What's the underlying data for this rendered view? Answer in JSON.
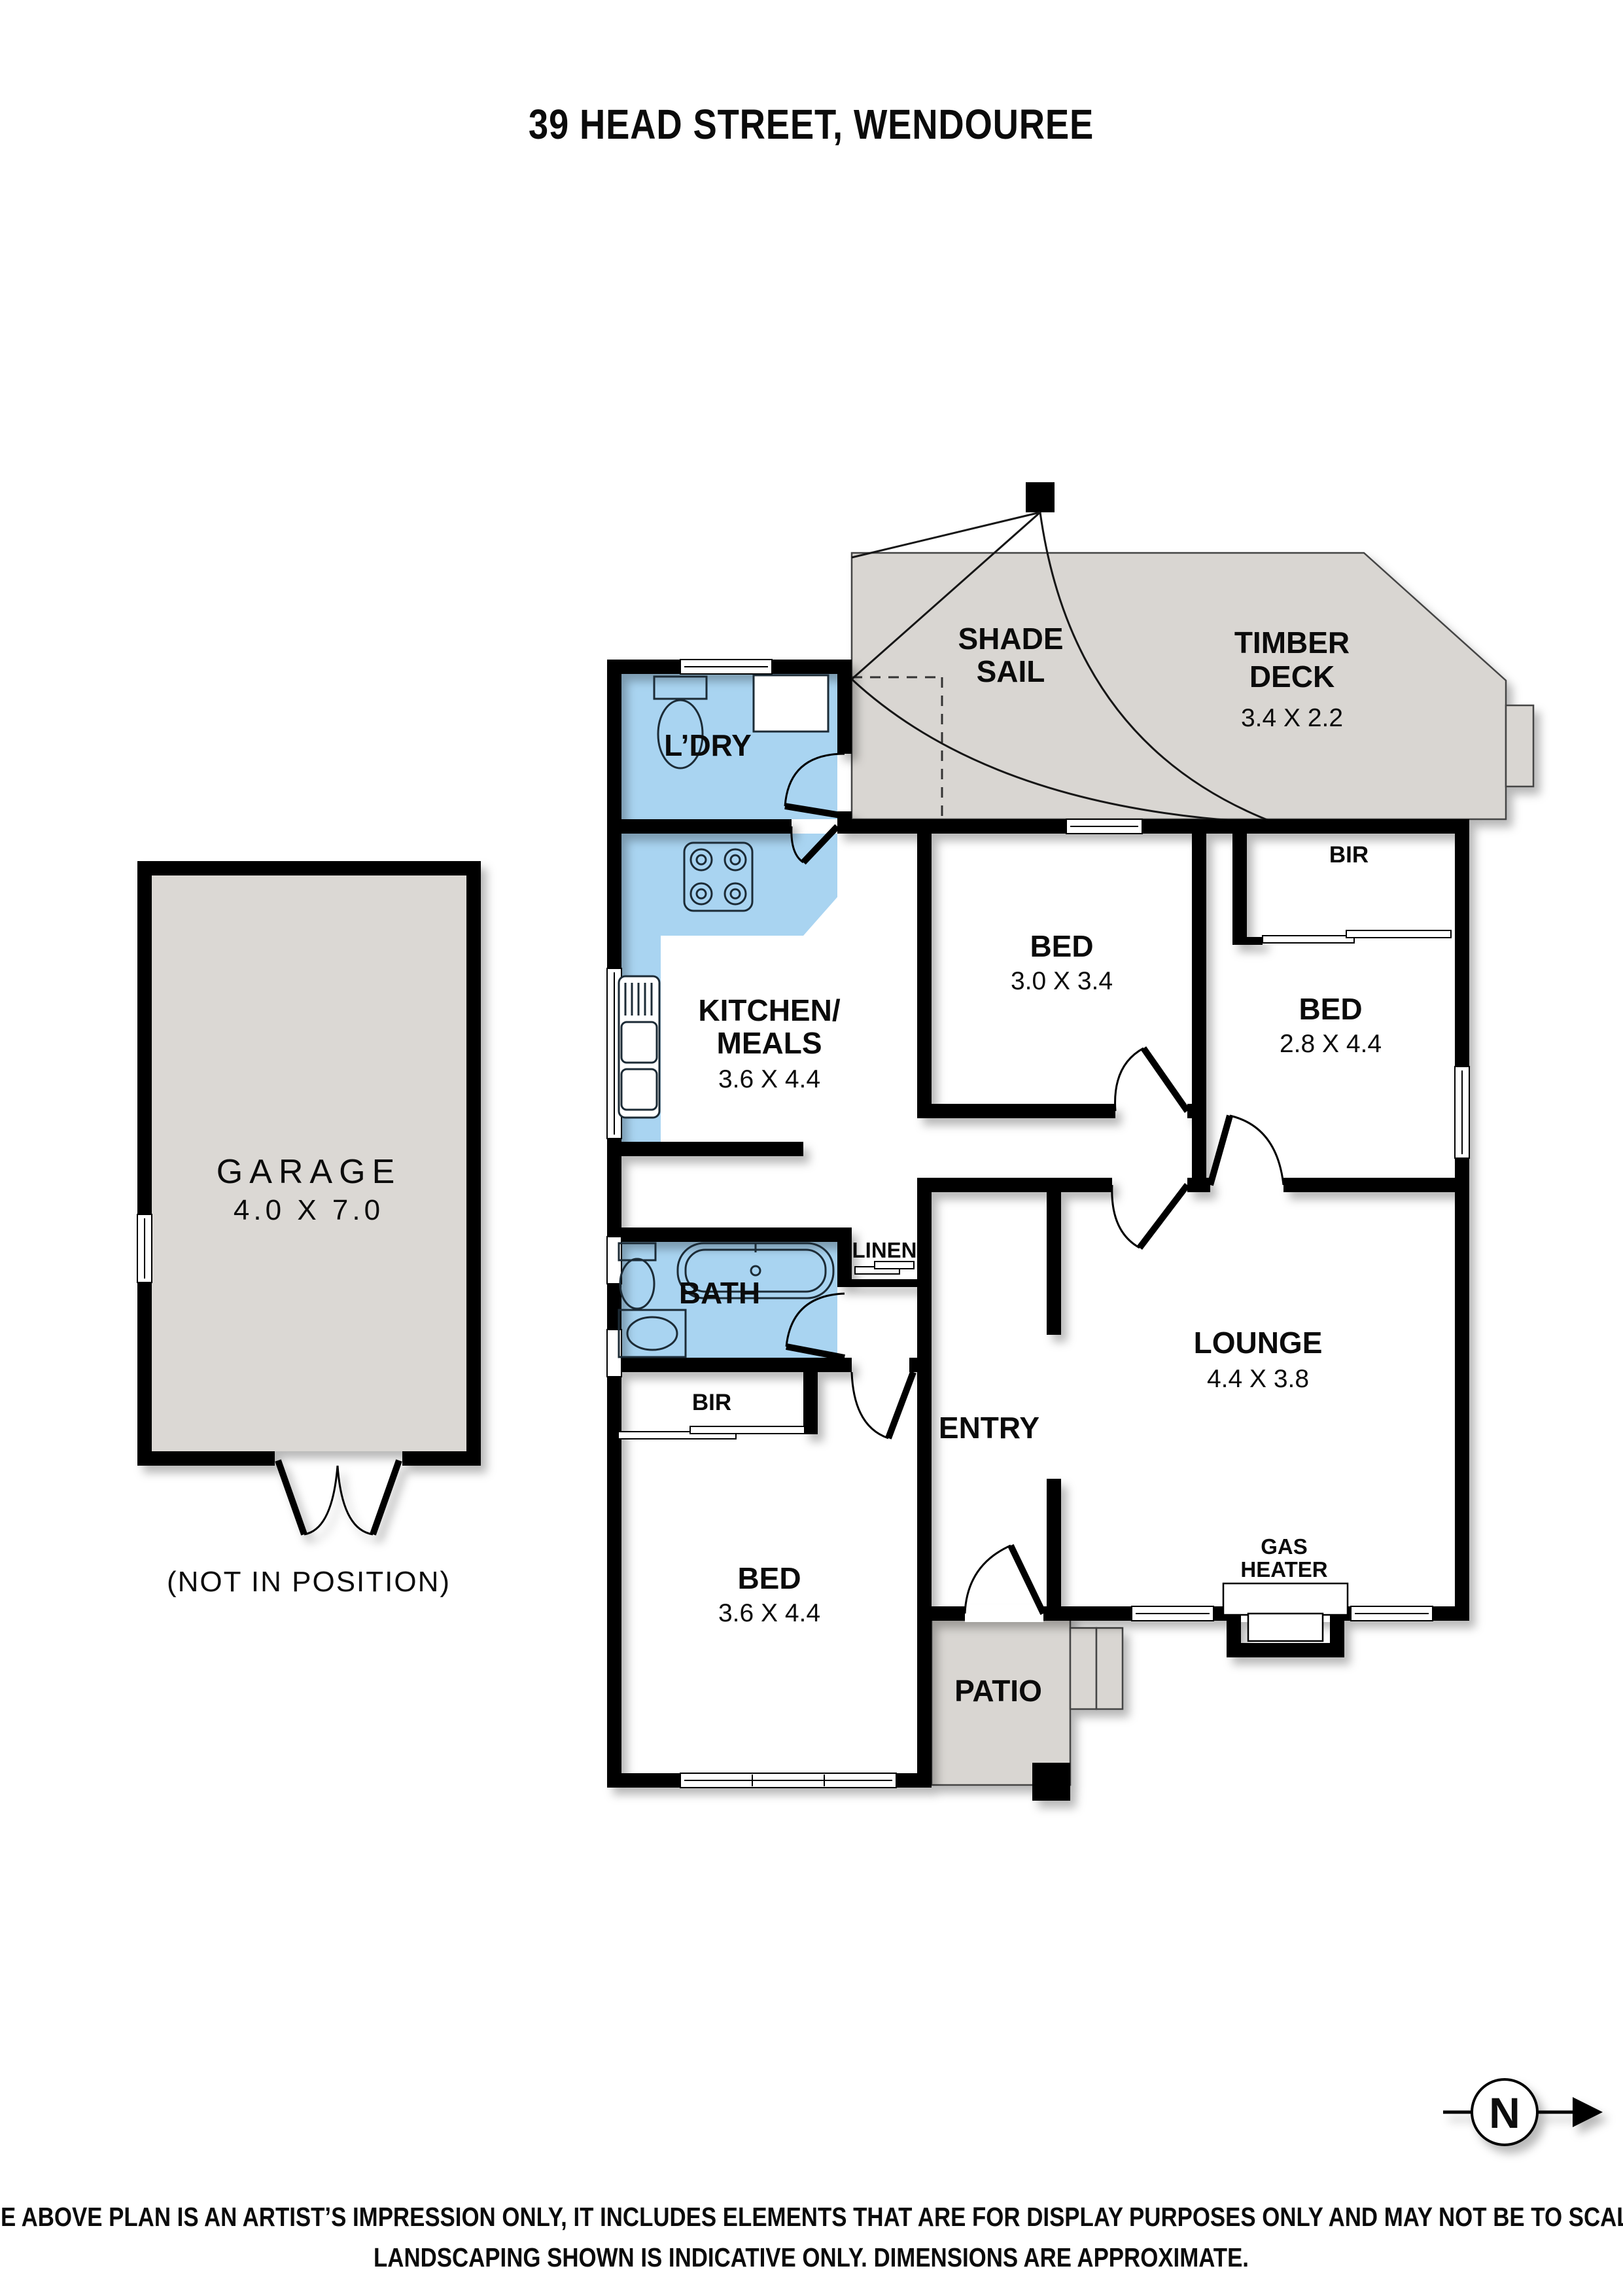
{
  "title": "39 HEAD STREET, WENDOUREE",
  "colors": {
    "wet_area_blue": "#A9D4F1",
    "hardscape_gray": "#D9D6D2",
    "garage_gray": "#DBD8D4",
    "wall_black": "#000000"
  },
  "rooms": {
    "shade_sail": {
      "line1": "SHADE",
      "line2": "SAIL"
    },
    "timber_deck": {
      "line1": "TIMBER",
      "line2": "DECK",
      "dims": "3.4 X 2.2"
    },
    "laundry": {
      "label": "L’DRY"
    },
    "kitchen": {
      "line1": "KITCHEN/",
      "line2": "MEALS",
      "dims": "3.6 X 4.4"
    },
    "bed1": {
      "label": "BED",
      "dims": "3.0 X 3.4"
    },
    "bed2": {
      "label": "BED",
      "dims": "2.8 X 4.4",
      "bir": "BIR"
    },
    "garage": {
      "label": "GARAGE",
      "dims": "4.0 X 7.0",
      "note": "(NOT IN POSITION)"
    },
    "bath": {
      "label": "BATH"
    },
    "linen": {
      "label": "LINEN"
    },
    "bed3": {
      "label": "BED",
      "dims": "3.6 X 4.4",
      "bir": "BIR"
    },
    "entry": {
      "label": "ENTRY"
    },
    "lounge": {
      "label": "LOUNGE",
      "dims": "4.4 X 3.8"
    },
    "gas_heater": {
      "line1": "GAS",
      "line2": "HEATER"
    },
    "patio": {
      "label": "PATIO"
    }
  },
  "compass": {
    "label": "N"
  },
  "disclaimer": {
    "line1": "THE ABOVE PLAN IS AN ARTIST’S IMPRESSION ONLY, IT INCLUDES ELEMENTS THAT ARE FOR DISPLAY PURPOSES ONLY AND MAY NOT BE TO SCALE.",
    "line2": "LANDSCAPING SHOWN IS INDICATIVE ONLY. DIMENSIONS ARE APPROXIMATE."
  }
}
